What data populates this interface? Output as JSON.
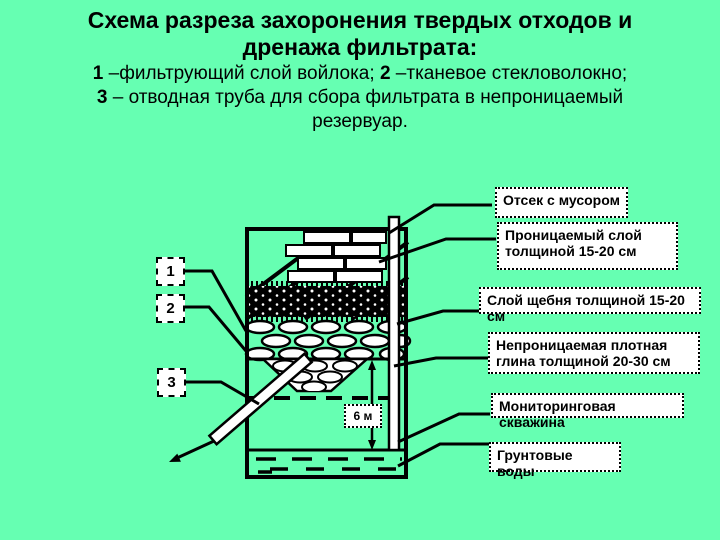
{
  "title": {
    "line1": "Схема разреза захоронения твердых отходов и",
    "line2": "дренажа фильтрата:"
  },
  "legend": [
    {
      "num": "1",
      "text": "–фильтрующий слой войлока;"
    },
    {
      "num": "2",
      "text": "–тканевое стекловолокно;"
    },
    {
      "num": "3",
      "text": "– отводная труба для сбора фильтрата в непроницаемый резервуар."
    }
  ],
  "diagram": {
    "number_boxes": [
      "1",
      "2",
      "3"
    ],
    "dimension_label": "6 м",
    "callouts": [
      {
        "id": "waste-compartment",
        "label": "Отсек с мусором"
      },
      {
        "id": "permeable-layer",
        "label": "Проницаемый слой толщиной 15-20 см"
      },
      {
        "id": "gravel-layer",
        "label": "Слой щебня толщиной 15-20 см"
      },
      {
        "id": "clay-layer",
        "label": "Непроницаемая плотная глина толщиной 20-30 см"
      },
      {
        "id": "monitoring-well",
        "label": "Мониторинговая скважина"
      },
      {
        "id": "groundwater",
        "label": "Грунтовые воды"
      }
    ]
  },
  "colors": {
    "background": "#66FFB2",
    "ink": "#000000",
    "box_fill": "#FFFFFF"
  }
}
